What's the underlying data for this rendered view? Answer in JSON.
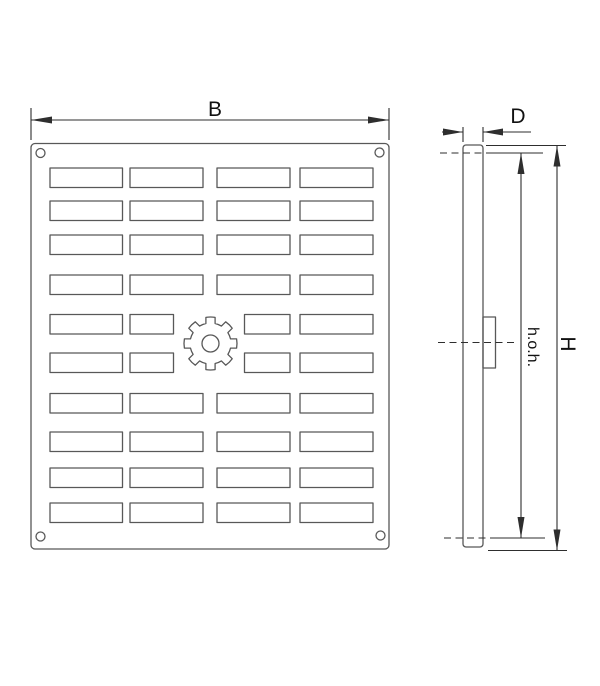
{
  "page": {
    "width_px": 600,
    "height_px": 686,
    "background": "#ffffff"
  },
  "drawing": {
    "kind": "technical-dimension-drawing",
    "views": {
      "front": {
        "slot_rows": 10,
        "slot_columns": 4,
        "rows_with_short_center_slots": 2,
        "corner_holes": 4,
        "center_knob_teeth": 8
      },
      "side": {
        "has_center_boss": true,
        "centerline_dashes": 3
      }
    },
    "dimensions": {
      "width": {
        "label": "B"
      },
      "depth": {
        "label": "D"
      },
      "height": {
        "label": "H"
      },
      "hole_pitch": {
        "label": "h.o.h."
      }
    },
    "colors": {
      "background": "#ffffff",
      "part_line": "#585858",
      "dimension_line": "#2e2e2e",
      "text": "#111111"
    }
  }
}
